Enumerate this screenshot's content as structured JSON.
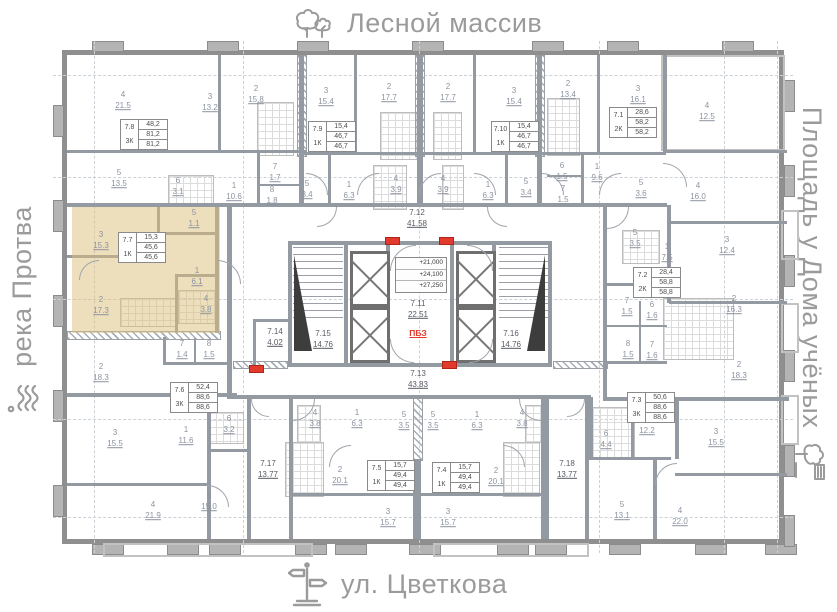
{
  "surroundings": {
    "top": "Лесной массив",
    "bottom": "ул. Цветкова",
    "left": "река Протва",
    "right": "Площадь у Дома учёных"
  },
  "colors": {
    "highlight": "#decb7a",
    "wall": "#8f8f8f",
    "room_label": "#8c93a0",
    "danger_red": "#e23b2e",
    "periphery_text": "#9b9b9b"
  },
  "core": {
    "elevations": [
      "+21,000",
      "+24,100",
      "+27,250"
    ],
    "safety_zone_label": "ПБЗ"
  },
  "corridors": [
    {
      "id": "7.12",
      "area": "41.58",
      "x": 350,
      "y": 163
    },
    {
      "id": "7.11",
      "area": "22.51",
      "x": 351,
      "y": 254
    },
    {
      "id": "7.13",
      "area": "43.83",
      "x": 351,
      "y": 324
    },
    {
      "id": "7.14",
      "area": "4.02",
      "x": 208,
      "y": 282
    },
    {
      "id": "7.15",
      "area": "14.76",
      "x": 256,
      "y": 284
    },
    {
      "id": "7.16",
      "area": "14.76",
      "x": 444,
      "y": 284
    },
    {
      "id": "7.17",
      "area": "13.77",
      "x": 201,
      "y": 414
    },
    {
      "id": "7.18",
      "area": "13.77",
      "x": 500,
      "y": 414
    }
  ],
  "apartments": [
    {
      "id": "7.8",
      "type": "3К",
      "values": [
        "48,2",
        "81,2",
        "81,2"
      ],
      "x": 53,
      "y": 64,
      "highlighted": false
    },
    {
      "id": "7.9",
      "type": "1К",
      "values": [
        "15,4",
        "46,7",
        "46,7"
      ],
      "x": 241,
      "y": 66,
      "highlighted": false
    },
    {
      "id": "7.10",
      "type": "1К",
      "values": [
        "15,4",
        "46,7",
        "46,7"
      ],
      "x": 424,
      "y": 66,
      "highlighted": false
    },
    {
      "id": "7.1",
      "type": "2К",
      "values": [
        "28,6",
        "58,2",
        "58,2"
      ],
      "x": 542,
      "y": 52,
      "highlighted": false
    },
    {
      "id": "7.7",
      "type": "1К",
      "values": [
        "15,3",
        "45,6",
        "45,6"
      ],
      "x": 51,
      "y": 177,
      "highlighted": true
    },
    {
      "id": "7.2",
      "type": "2К",
      "values": [
        "28,4",
        "58,8",
        "58,8"
      ],
      "x": 566,
      "y": 212,
      "highlighted": false
    },
    {
      "id": "7.6",
      "type": "3К",
      "values": [
        "52,4",
        "88,6",
        "88,6"
      ],
      "x": 103,
      "y": 327,
      "highlighted": false
    },
    {
      "id": "7.3",
      "type": "3К",
      "values": [
        "50,6",
        "88,6",
        "88,6"
      ],
      "x": 560,
      "y": 337,
      "highlighted": false
    },
    {
      "id": "7.5",
      "type": "1К",
      "values": [
        "15,7",
        "49,4",
        "49,4"
      ],
      "x": 300,
      "y": 405,
      "highlighted": false
    },
    {
      "id": "7.4",
      "type": "1К",
      "values": [
        "15,7",
        "49,4",
        "49,4"
      ],
      "x": 365,
      "y": 407,
      "highlighted": false
    }
  ],
  "rooms": [
    {
      "n": "4",
      "a": "21.5",
      "x": 56,
      "y": 46
    },
    {
      "n": "3",
      "a": "13.2",
      "x": 143,
      "y": 48
    },
    {
      "n": "2",
      "a": "15.8",
      "x": 189,
      "y": 40
    },
    {
      "n": "5",
      "a": "13.5",
      "x": 52,
      "y": 124
    },
    {
      "n": "6",
      "a": "3.1",
      "x": 111,
      "y": 132
    },
    {
      "n": "1",
      "a": "10.6",
      "x": 167,
      "y": 137
    },
    {
      "n": "7",
      "a": "1.7",
      "x": 208,
      "y": 118
    },
    {
      "n": "8",
      "a": "1.8",
      "x": 205,
      "y": 141
    },
    {
      "n": "5",
      "a": "3.4",
      "x": 240,
      "y": 135
    },
    {
      "n": "3",
      "a": "15.4",
      "x": 259,
      "y": 42
    },
    {
      "n": "1",
      "a": "6.3",
      "x": 282,
      "y": 136
    },
    {
      "n": "4",
      "a": "3.9",
      "x": 329,
      "y": 130
    },
    {
      "n": "2",
      "a": "17.7",
      "x": 322,
      "y": 38
    },
    {
      "n": "2",
      "a": "17.7",
      "x": 381,
      "y": 38
    },
    {
      "n": "4",
      "a": "3.9",
      "x": 376,
      "y": 130
    },
    {
      "n": "1",
      "a": "6.3",
      "x": 421,
      "y": 136
    },
    {
      "n": "5",
      "a": "3.4",
      "x": 459,
      "y": 133
    },
    {
      "n": "3",
      "a": "15.4",
      "x": 447,
      "y": 42
    },
    {
      "n": "2",
      "a": "13.4",
      "x": 501,
      "y": 35
    },
    {
      "n": "3",
      "a": "16.1",
      "x": 571,
      "y": 40
    },
    {
      "n": "4",
      "a": "12.5",
      "x": 640,
      "y": 57
    },
    {
      "n": "6",
      "a": "1.5",
      "x": 495,
      "y": 117
    },
    {
      "n": "7",
      "a": "1.5",
      "x": 496,
      "y": 140
    },
    {
      "n": "1",
      "a": "9.6",
      "x": 530,
      "y": 118
    },
    {
      "n": "5",
      "a": "3.6",
      "x": 574,
      "y": 134
    },
    {
      "n": "4",
      "a": "16.0",
      "x": 631,
      "y": 137
    },
    {
      "n": "3",
      "a": "15.3",
      "x": 34,
      "y": 186
    },
    {
      "n": "5",
      "a": "1.1",
      "x": 127,
      "y": 164
    },
    {
      "n": "1",
      "a": "6.1",
      "x": 130,
      "y": 222
    },
    {
      "n": "4",
      "a": "3.8",
      "x": 139,
      "y": 250
    },
    {
      "n": "2",
      "a": "17.3",
      "x": 34,
      "y": 251
    },
    {
      "n": "2",
      "a": "18.3",
      "x": 34,
      "y": 318
    },
    {
      "n": "7",
      "a": "1.4",
      "x": 115,
      "y": 295
    },
    {
      "n": "8",
      "a": "1.5",
      "x": 142,
      "y": 295
    },
    {
      "n": "5",
      "a": "3.5",
      "x": 568,
      "y": 184
    },
    {
      "n": "1",
      "a": "7.5",
      "x": 600,
      "y": 198
    },
    {
      "n": "3",
      "a": "12.4",
      "x": 660,
      "y": 191
    },
    {
      "n": "2",
      "a": "16.3",
      "x": 667,
      "y": 250
    },
    {
      "n": "7",
      "a": "1.5",
      "x": 560,
      "y": 252
    },
    {
      "n": "6",
      "a": "1.6",
      "x": 585,
      "y": 256
    },
    {
      "n": "8",
      "a": "1.5",
      "x": 561,
      "y": 295
    },
    {
      "n": "7",
      "a": "1.6",
      "x": 585,
      "y": 296
    },
    {
      "n": "2",
      "a": "18.3",
      "x": 672,
      "y": 316
    },
    {
      "n": "3",
      "a": "15.5",
      "x": 48,
      "y": 384
    },
    {
      "n": "1",
      "a": "11.6",
      "x": 119,
      "y": 381
    },
    {
      "n": "6",
      "a": "3.2",
      "x": 162,
      "y": 370
    },
    {
      "n": "4",
      "a": "21.9",
      "x": 86,
      "y": 456
    },
    {
      "n": "5",
      "a": "15.0",
      "x": 142,
      "y": 447
    },
    {
      "n": "4",
      "a": "3.8",
      "x": 248,
      "y": 364
    },
    {
      "n": "1",
      "a": "6.3",
      "x": 290,
      "y": 364
    },
    {
      "n": "5",
      "a": "3.5",
      "x": 337,
      "y": 366
    },
    {
      "n": "2",
      "a": "20.1",
      "x": 273,
      "y": 421
    },
    {
      "n": "3",
      "a": "15.7",
      "x": 321,
      "y": 463
    },
    {
      "n": "5",
      "a": "3.5",
      "x": 366,
      "y": 366
    },
    {
      "n": "1",
      "a": "6.3",
      "x": 410,
      "y": 366
    },
    {
      "n": "4",
      "a": "3.8",
      "x": 455,
      "y": 364
    },
    {
      "n": "2",
      "a": "20.1",
      "x": 429,
      "y": 422
    },
    {
      "n": "3",
      "a": "15.7",
      "x": 381,
      "y": 463
    },
    {
      "n": "6",
      "a": "4.4",
      "x": 539,
      "y": 385
    },
    {
      "n": "1",
      "a": "12.2",
      "x": 580,
      "y": 371
    },
    {
      "n": "3",
      "a": "15.5",
      "x": 649,
      "y": 383
    },
    {
      "n": "5",
      "a": "13.1",
      "x": 555,
      "y": 456
    },
    {
      "n": "4",
      "a": "22.0",
      "x": 613,
      "y": 462
    }
  ]
}
